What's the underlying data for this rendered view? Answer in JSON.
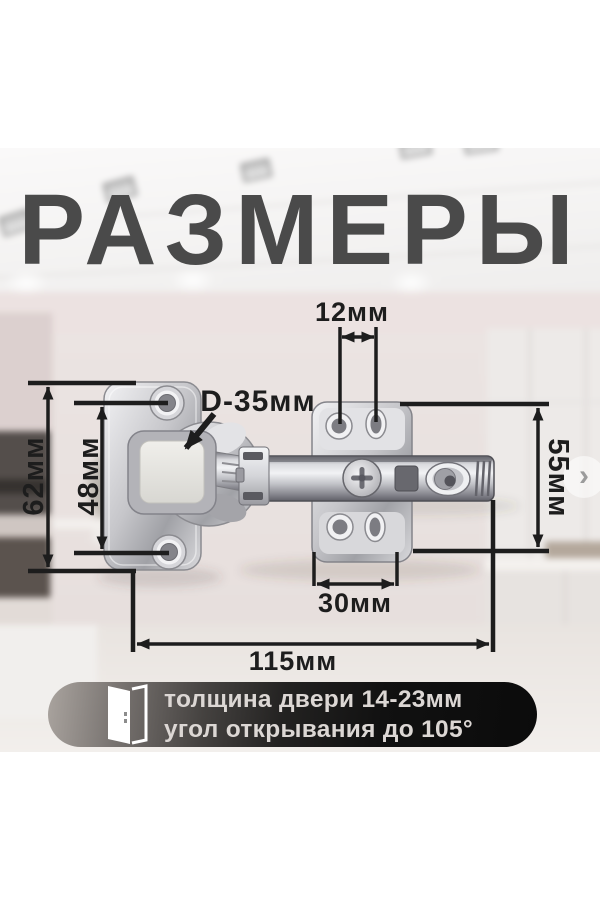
{
  "title": "РАЗМЕРЫ",
  "annotations": {
    "hole_pitch_top": "12мм",
    "cup_diameter": "D-35мм",
    "plate_outer_height": "62мм",
    "screw_spacing": "48мм",
    "mount_plate_height": "55мм",
    "mount_plate_width": "30мм",
    "total_length": "115мм"
  },
  "info_banner": {
    "door_icon": "open-door-icon",
    "line1": "толщина двери 14-23мм",
    "line2": "угол открывания до 105°"
  },
  "carousel": {
    "next_arrow": "›"
  },
  "colors": {
    "title": "#4a4a4a",
    "annotation": "#1d1d1d",
    "banner_text": "#dcd7d4",
    "banner_dark": "#0b0b0b",
    "metal_light": "#f2f2f4",
    "metal_dark": "#8a8a90"
  }
}
